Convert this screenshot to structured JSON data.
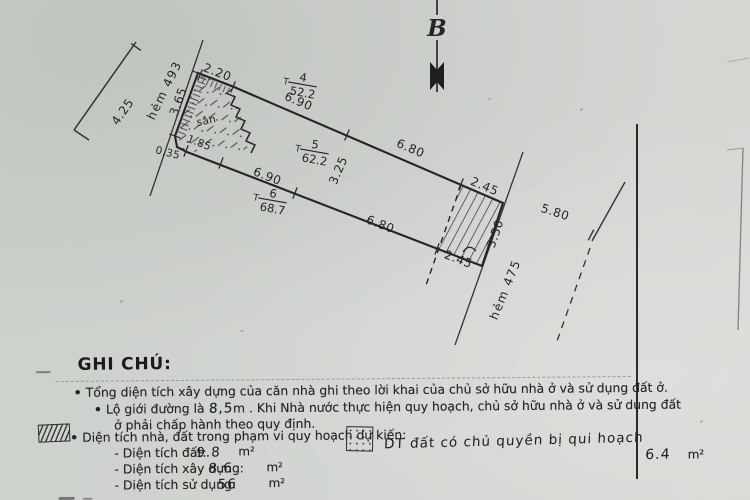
{
  "page": {
    "bullet": "•"
  },
  "compass": {
    "north_label": "B"
  },
  "diagram": {
    "left_road": {
      "name": "hẻm 493",
      "width": "4.25"
    },
    "right_road": {
      "name": "hẻm 475",
      "width": "5.80"
    },
    "yard_label": "sân",
    "lots": [
      {
        "prefix": "T",
        "id": "4",
        "area": "52.2"
      },
      {
        "prefix": "T",
        "id": "5",
        "area": "62.2"
      },
      {
        "prefix": "T",
        "id": "6",
        "area": "68.7"
      }
    ],
    "dims": {
      "top_short": "2.20",
      "left_side": "3.65",
      "step": "0.35",
      "bottom_short": "1.85",
      "top_a": "6.90",
      "top_b": "6.80",
      "top_right": "2.45",
      "mid_width": "3.25",
      "bottom_a": "6.90",
      "bottom_b": "6.80",
      "bottom_right": "2.45",
      "right_side": "3.50"
    }
  },
  "legend": {
    "title": "GHI CHÚ:",
    "note1": "Tổng diện tích xây dựng của căn nhà ghi theo lời khai của chủ sở hữu nhà ở và sử dụng đất ở.",
    "note2_pre": "Lộ giới đường là ",
    "note2_value": "8,5",
    "note2_mid": "m . Khi Nhà nước thực hiện quy hoạch, chủ sở hữu nhà ở và sử dụng đất",
    "note2_line2": "ở phải chấp hành theo quy định.",
    "note3_label": "Diện tích nhà, đất trong phạm vi quy hoạch dự kiến:",
    "note3_hand": "DT đất có chủ quyền bị qui hoạch",
    "note3_value": "6.4",
    "note3_unit": "m²",
    "rows": [
      {
        "label": "- Diện tích đất:",
        "value": "9.8",
        "unit": "m²"
      },
      {
        "label": "- Diện tích xây dựng:",
        "value": "8.6",
        "unit": "m²"
      },
      {
        "label": "- Diện tích sử dụng:",
        "value": "56",
        "unit": "m²"
      }
    ]
  }
}
